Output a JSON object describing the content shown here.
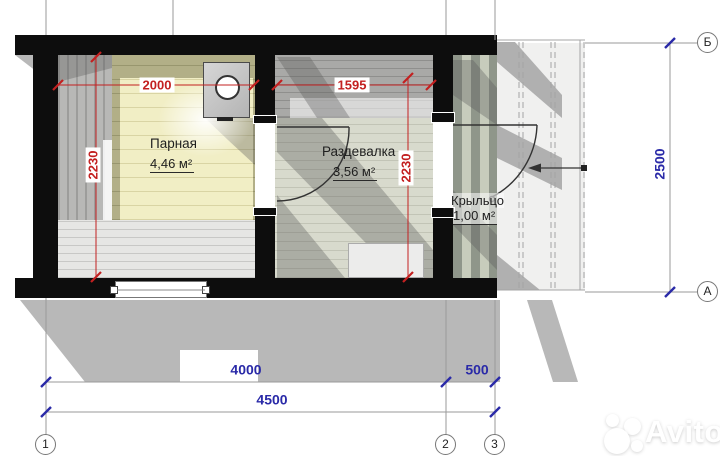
{
  "plan": {
    "rooms": [
      {
        "name": "Парная",
        "area": "4,46 м²"
      },
      {
        "name": "Раздевалка",
        "area": "3,56 м²"
      },
      {
        "name": "Крыльцо",
        "area": "1,00 м²"
      }
    ],
    "dims": {
      "d2000": "2000",
      "d1595": "1595",
      "d2230_left": "2230",
      "d2230_mid": "2230",
      "d2500": "2500",
      "d4000": "4000",
      "d500": "500",
      "d4500": "4500"
    },
    "axes": {
      "a1": "1",
      "a2": "2",
      "a3": "3",
      "aA": "А",
      "aB": "Б"
    },
    "colors": {
      "dim_red": "#c32020",
      "dim_blue": "#2a2aa8",
      "wall": "#0d0d0d",
      "floor_olive": "#b2af87",
      "floor_cream": "#f1eec5",
      "shadow": "#b8b8b8"
    }
  },
  "watermark": {
    "brand": "Avito"
  }
}
